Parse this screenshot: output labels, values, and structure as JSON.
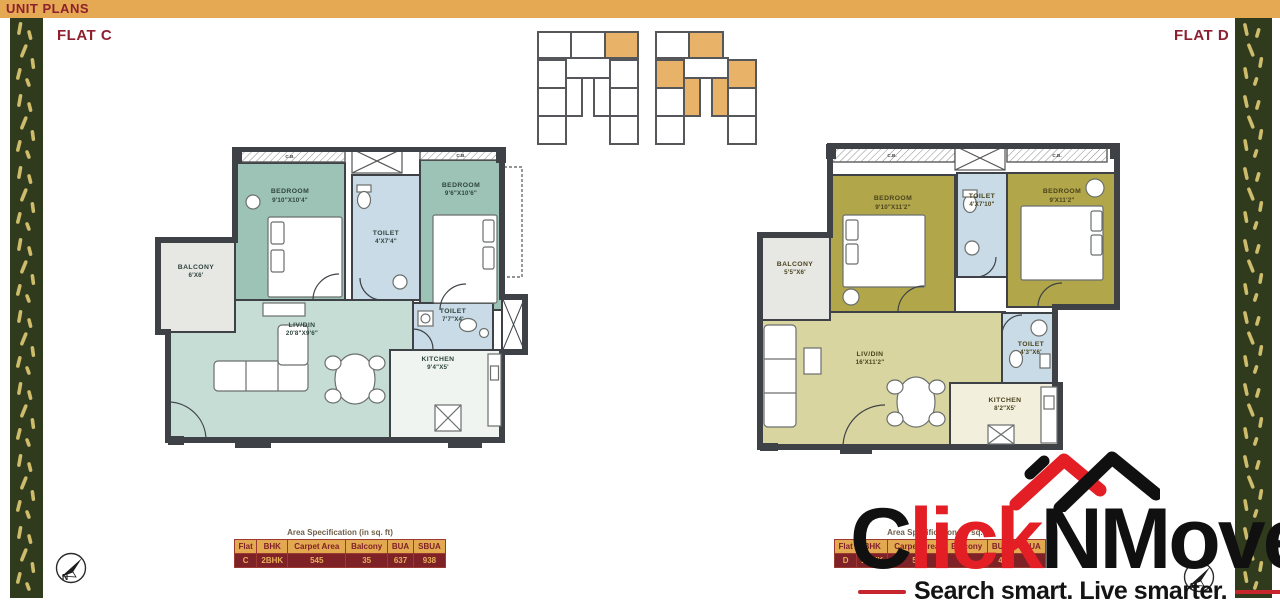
{
  "header": {
    "title": "UNIT PLANS"
  },
  "flat_c": {
    "label": "FLAT C",
    "closet_label": "C.B.",
    "rooms": {
      "bedroom1": {
        "name": "BEDROOM",
        "dims": "9'10\"X10'4\""
      },
      "toilet1": {
        "name": "TOILET",
        "dims": "4'X7'4\""
      },
      "bedroom2": {
        "name": "BEDROOM",
        "dims": "9'6\"X10'6\""
      },
      "balcony": {
        "name": "BALCONY",
        "dims": "6'X6'"
      },
      "livdin": {
        "name": "LIV/DIN",
        "dims": "20'8\"X9'6\""
      },
      "toilet2": {
        "name": "TOILET",
        "dims": "7'7\"X4'"
      },
      "kitchen": {
        "name": "KITCHEN",
        "dims": "9'4\"X5'"
      }
    },
    "table": {
      "title": "Area Specification (in sq. ft)",
      "headers": [
        "Flat",
        "BHK",
        "Carpet Area",
        "Balcony",
        "BUA",
        "SBUA"
      ],
      "row": [
        "C",
        "2BHK",
        "545",
        "35",
        "637",
        "938"
      ]
    }
  },
  "flat_d": {
    "label": "FLAT D",
    "closet_label": "C.B.",
    "rooms": {
      "bedroom1": {
        "name": "BEDROOM",
        "dims": "9'10\"X11'2\""
      },
      "toilet1": {
        "name": "TOILET",
        "dims": "4'X7'10\""
      },
      "bedroom2": {
        "name": "BEDROOM",
        "dims": "9'X11'2\""
      },
      "balcony": {
        "name": "BALCONY",
        "dims": "5'5\"X6'"
      },
      "livdin": {
        "name": "LIV/DIN",
        "dims": "16'X11'2\""
      },
      "toilet2": {
        "name": "TOILET",
        "dims": "4'3\"X6'"
      },
      "kitchen": {
        "name": "KITCHEN",
        "dims": "8'2\"X5'"
      }
    },
    "table": {
      "title": "Area Specification (in sq. ft)",
      "headers": [
        "Flat",
        "BHK",
        "Carpet Area",
        "Balcony",
        "BUA",
        "SBUA"
      ],
      "row": [
        "D",
        "2BHK",
        "55",
        "3",
        "4",
        ""
      ]
    }
  },
  "logo": {
    "part1": "C",
    "part2": "lick",
    "part3": "NMove",
    "tagline": "Search smart. Live smarter."
  },
  "compass": {
    "label": "N"
  },
  "colors": {
    "accent_orange": "#E5A853",
    "maroon": "#8E1F2F",
    "logo_red": "#E31E25",
    "flat_c_room": "#9DC3B6",
    "flat_d_room": "#B1A64A",
    "toilet_blue": "#C9DBE6",
    "border_green": "#303A1D"
  }
}
